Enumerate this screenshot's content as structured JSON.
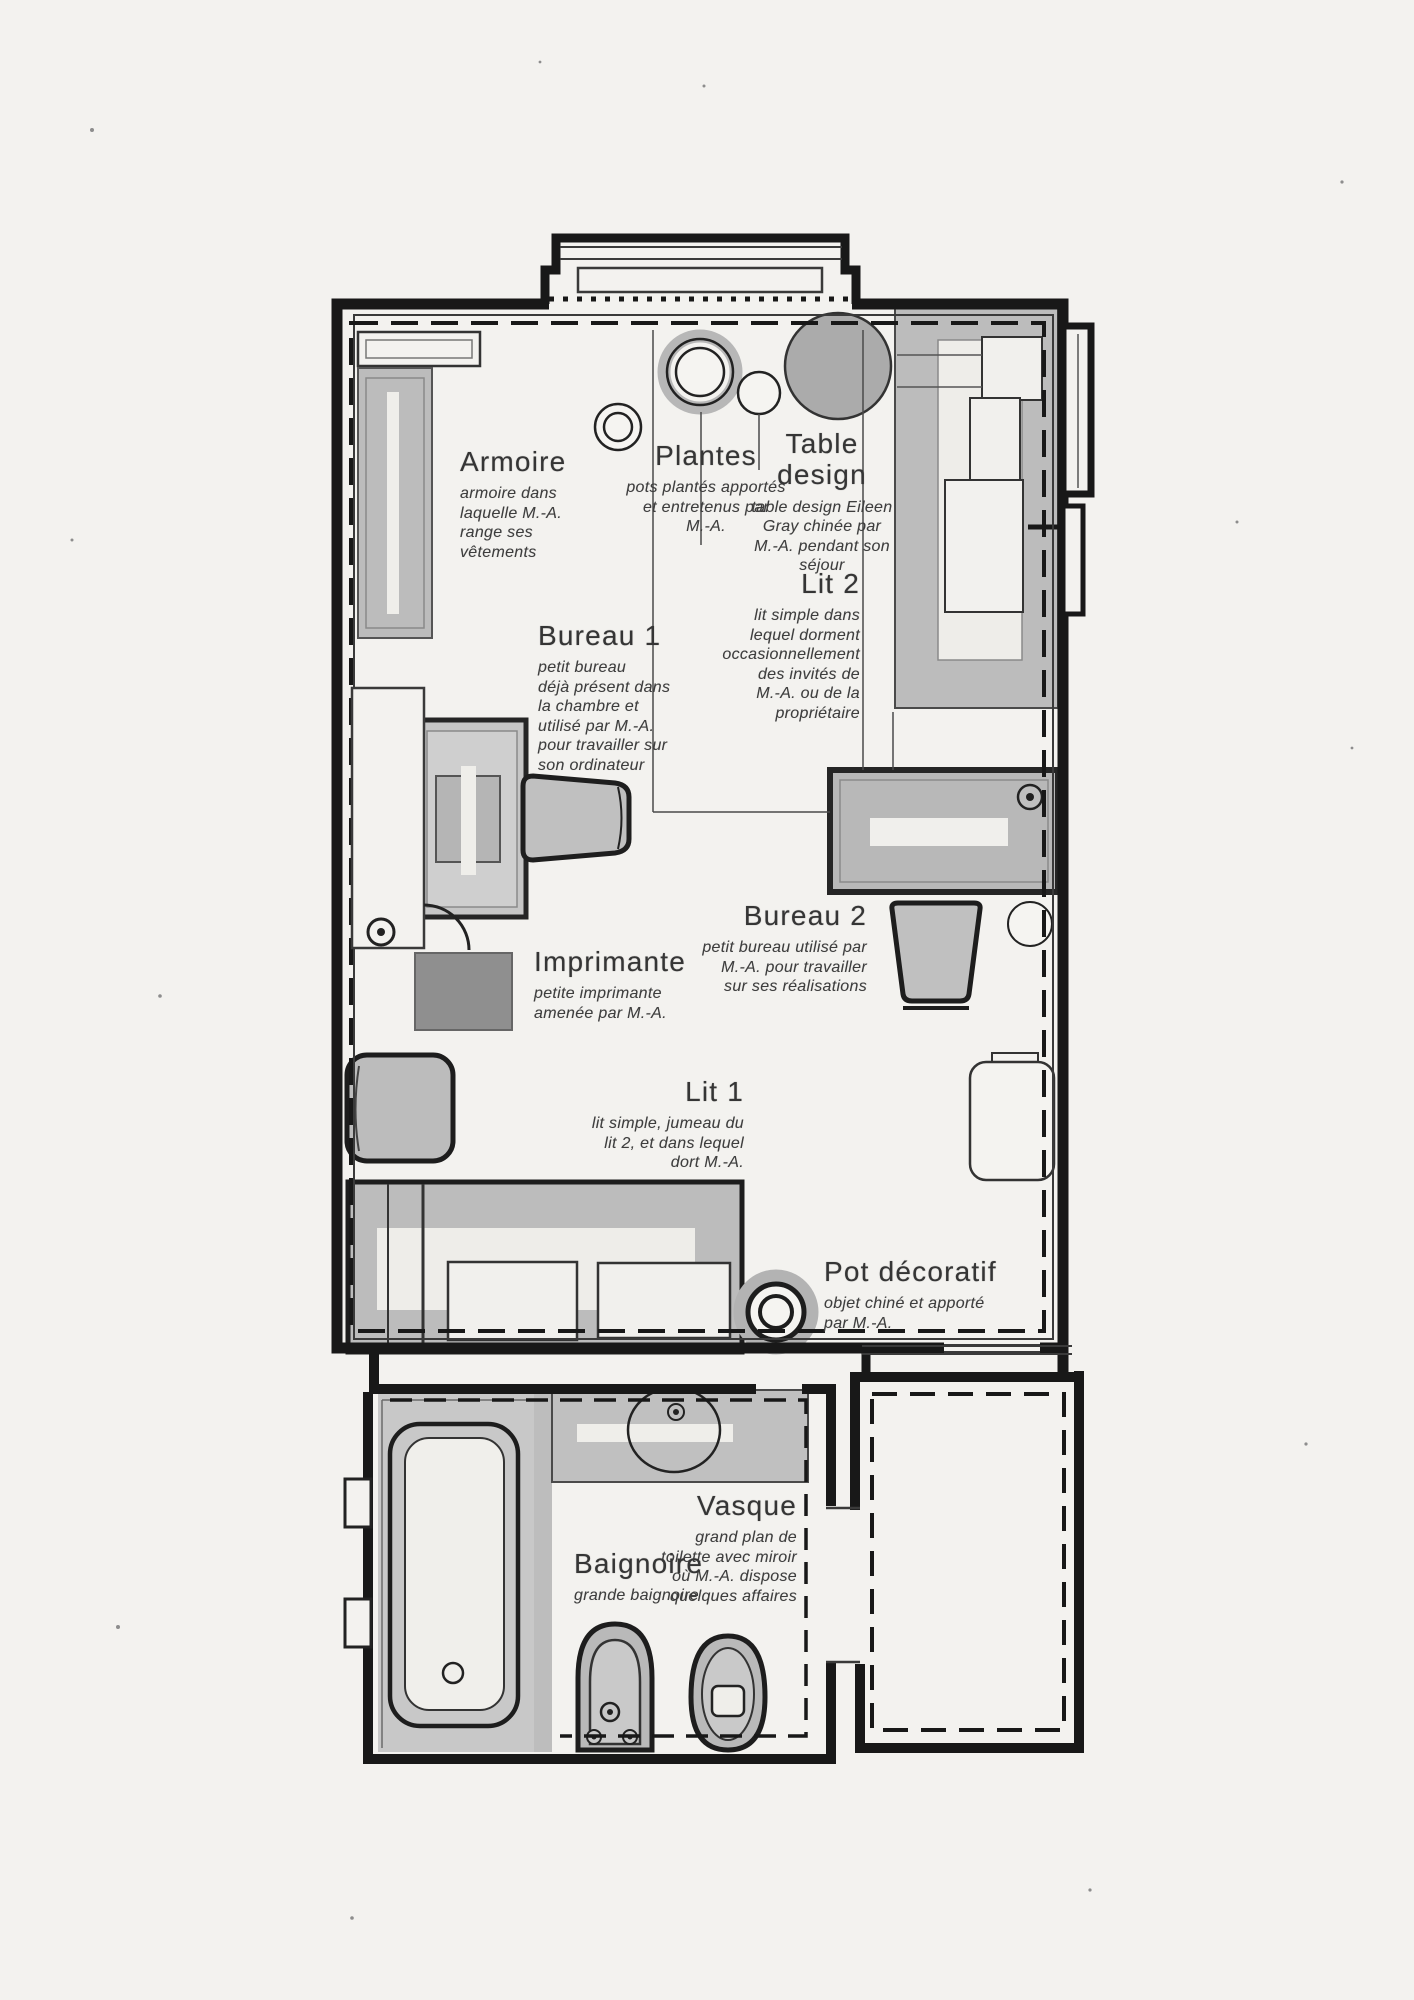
{
  "colors": {
    "paper": "#f3f2ef",
    "ink": "#1b1b1b",
    "furniture_gray": "#c0c0c0",
    "dark_gray": "#8f8f8f",
    "label_text": "#353535"
  },
  "labels": {
    "armoire": {
      "title": "Armoire",
      "description": "armoire dans\nlaquelle M.-A.\nrange ses\nvêtements"
    },
    "plantes": {
      "title": "Plantes",
      "description": "pots plantés apportés\net entretenus par\nM.-A."
    },
    "table_design": {
      "title": "Table\ndesign",
      "description": "table design Eileen\nGray chinée par\nM.-A. pendant son\nséjour"
    },
    "lit2": {
      "title": "Lit 2",
      "description": "lit simple dans\nlequel dorment\noccasionnellement\ndes invités de\nM.-A. ou de la\npropriétaire"
    },
    "bureau1": {
      "title": "Bureau 1",
      "description": "petit bureau\ndéjà présent dans\nla chambre et\nutilisé par M.-A.\npour travailler sur\nson ordinateur"
    },
    "imprimante": {
      "title": "Imprimante",
      "description": "petite imprimante\namenée par M.-A."
    },
    "bureau2": {
      "title": "Bureau 2",
      "description": "petit bureau utilisé par\nM.-A. pour travailler\nsur ses réalisations"
    },
    "lit1": {
      "title": "Lit 1",
      "description": "lit simple, jumeau du\nlit 2, et dans lequel\ndort M.-A."
    },
    "pot_decoratif": {
      "title": "Pot décoratif",
      "description": "objet chiné et apporté\npar M.-A."
    },
    "vasque": {
      "title": "Vasque",
      "description": "grand plan de\ntoilette avec miroir\noù M.-A. dispose\nquelques affaires"
    },
    "baignoire": {
      "title": "Baignoire",
      "description": "grande baignoire"
    }
  }
}
